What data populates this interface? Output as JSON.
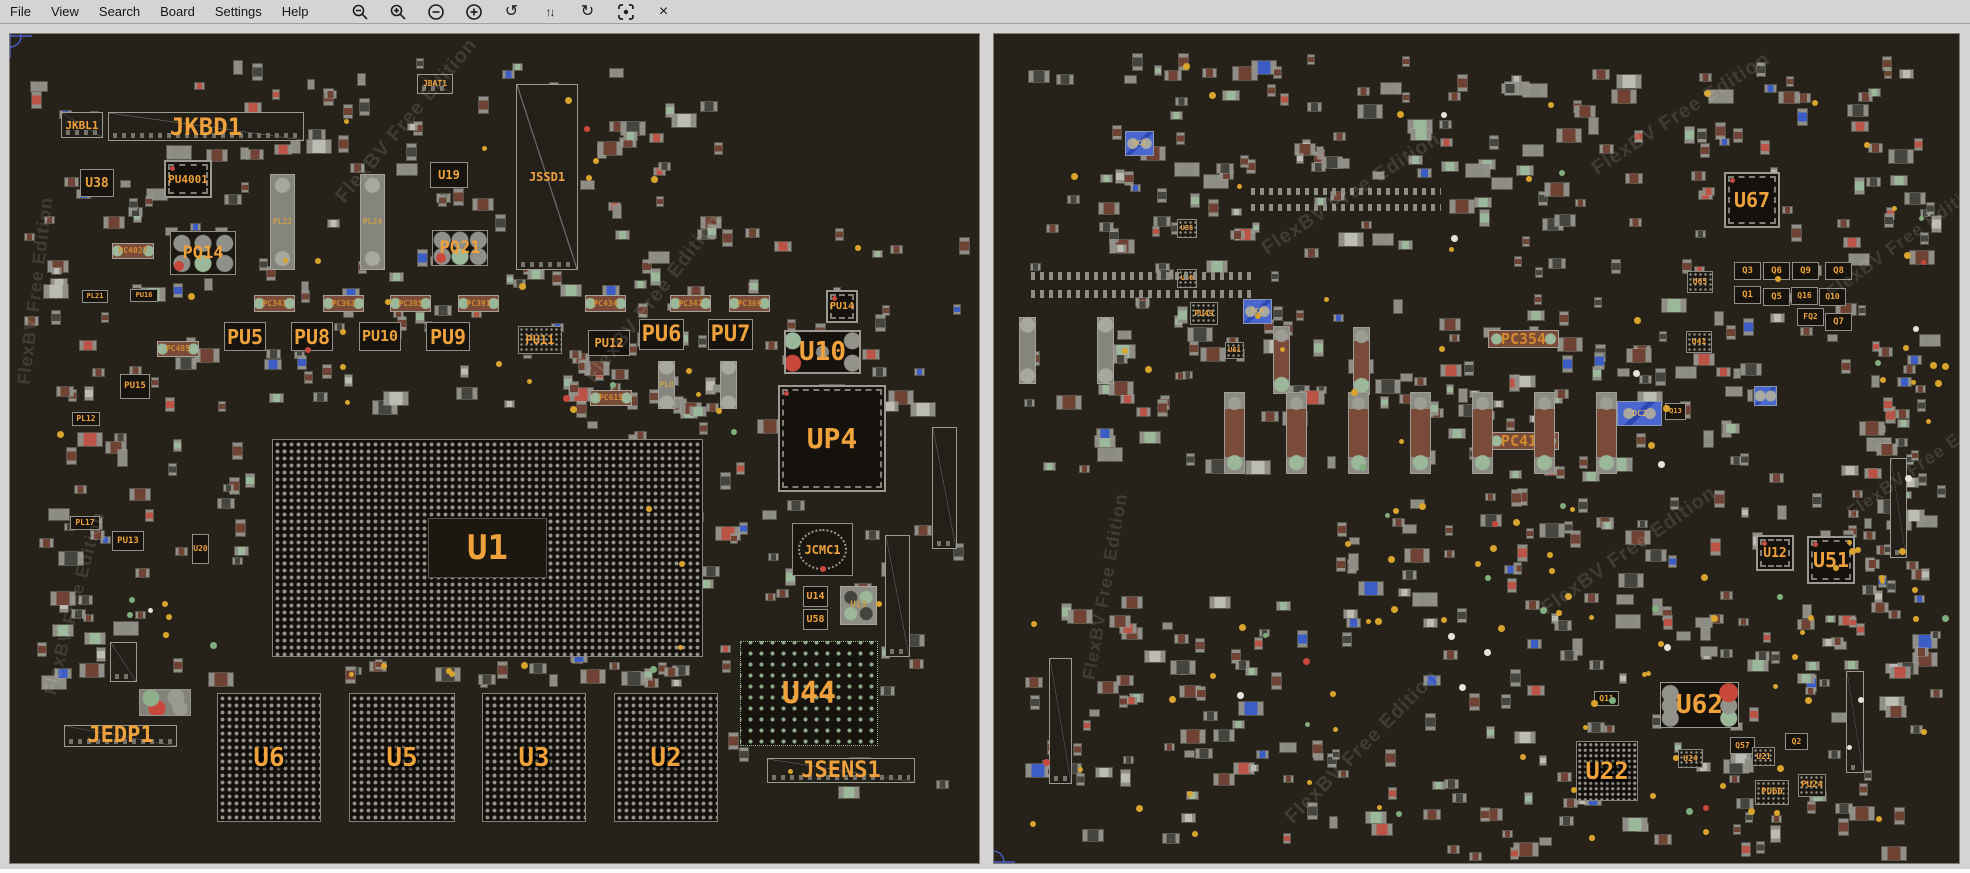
{
  "menu": {
    "items": [
      "File",
      "View",
      "Search",
      "Board",
      "Settings",
      "Help"
    ]
  },
  "toolbar": {
    "icons": [
      {
        "name": "zoom-out-icon",
        "kind": "svg-zoom-out"
      },
      {
        "name": "zoom-in-icon",
        "kind": "svg-zoom-in"
      },
      {
        "name": "minus-circle-icon",
        "kind": "svg-minus-circle"
      },
      {
        "name": "plus-circle-icon",
        "kind": "svg-plus-circle"
      },
      {
        "name": "rotate-ccw-icon",
        "kind": "glyph",
        "glyph": "↺"
      },
      {
        "name": "flip-vertical-icon",
        "kind": "glyph2",
        "glyph": "↑↓"
      },
      {
        "name": "rotate-cw-icon",
        "kind": "glyph",
        "glyph": "↻"
      },
      {
        "name": "center-target-icon",
        "kind": "svg-target"
      },
      {
        "name": "close-icon",
        "kind": "glyph",
        "glyph": "×"
      }
    ]
  },
  "watermark": "FlexBV Free Edition",
  "colors": {
    "menu_bg": "#d5d4d2",
    "board_bg": "#272219",
    "label_orange": "#efa23c",
    "blue_part": "#4a67cf",
    "test_point_yellow": "#d9a42e",
    "crosshair_blue": "#4b5fc7"
  },
  "left_board": {
    "components": [
      [
        "conn",
        "JKBL1",
        51,
        78,
        42,
        26,
        11
      ],
      [
        "conn",
        "JKBD1",
        98,
        78,
        196,
        29,
        24
      ],
      [
        "conn",
        "JSSD1",
        506,
        50,
        62,
        186,
        12
      ],
      [
        "conn",
        "JBAT1",
        407,
        40,
        36,
        20,
        8
      ],
      [
        "chip",
        "U38",
        70,
        135,
        34,
        28,
        13
      ],
      [
        "qfn",
        "PU4001",
        154,
        126,
        48,
        38,
        11
      ],
      [
        "chip",
        "U19",
        420,
        128,
        38,
        26,
        12
      ],
      [
        "pq",
        "PQ14",
        160,
        197,
        66,
        44,
        17
      ],
      [
        "pq",
        "PQ21",
        422,
        196,
        56,
        36,
        17
      ],
      [
        "pl",
        "PL22",
        260,
        140,
        25,
        96,
        8
      ],
      [
        "pl",
        "PL24",
        350,
        140,
        25,
        96,
        8
      ],
      [
        "cap",
        "PC4027",
        102,
        209,
        42,
        16,
        8
      ],
      [
        "chip",
        "PU16",
        120,
        255,
        28,
        13,
        7
      ],
      [
        "chip",
        "PL21",
        72,
        256,
        26,
        13,
        7
      ],
      [
        "cap",
        "PC341",
        244,
        261,
        41,
        17,
        8
      ],
      [
        "cap",
        "PC363",
        313,
        261,
        41,
        17,
        8
      ],
      [
        "cap",
        "PC385",
        380,
        261,
        41,
        17,
        8
      ],
      [
        "cap",
        "PC391",
        448,
        261,
        41,
        17,
        8
      ],
      [
        "cap",
        "PC434",
        575,
        261,
        41,
        17,
        8
      ],
      [
        "cap",
        "PC347",
        660,
        261,
        41,
        17,
        8
      ],
      [
        "cap",
        "PC369",
        719,
        261,
        41,
        17,
        8
      ],
      [
        "chip",
        "PU5",
        214,
        288,
        42,
        29,
        20
      ],
      [
        "chip",
        "PU8",
        281,
        288,
        42,
        29,
        20
      ],
      [
        "chip",
        "PU10",
        349,
        288,
        42,
        29,
        15
      ],
      [
        "chip",
        "PU9",
        416,
        288,
        44,
        29,
        20
      ],
      [
        "grid",
        "PU11",
        508,
        292,
        44,
        28,
        12
      ],
      [
        "chip",
        "PU12",
        578,
        296,
        42,
        26,
        12
      ],
      [
        "chip",
        "PU6",
        629,
        285,
        45,
        31,
        22
      ],
      [
        "chip",
        "PU7",
        698,
        285,
        45,
        31,
        22
      ],
      [
        "cap",
        "PC485",
        147,
        307,
        42,
        16,
        8
      ],
      [
        "chip",
        "PU15",
        110,
        340,
        30,
        25,
        9
      ],
      [
        "cap",
        "PC615",
        580,
        356,
        42,
        16,
        8
      ],
      [
        "pl",
        "PL8",
        648,
        327,
        17,
        48,
        8
      ],
      [
        "pl",
        "",
        710,
        327,
        17,
        48,
        0
      ],
      [
        "chip",
        "PL12",
        62,
        378,
        28,
        14,
        8
      ],
      [
        "chip",
        "PL17",
        60,
        482,
        30,
        14,
        8
      ],
      [
        "chip",
        "PU13",
        102,
        497,
        32,
        20,
        9
      ],
      [
        "chip",
        "U20",
        182,
        500,
        17,
        30,
        8
      ],
      [
        "qfn",
        "PU14",
        816,
        256,
        32,
        33,
        10
      ],
      [
        "u10",
        "U10",
        774,
        296,
        77,
        44,
        26
      ],
      [
        "qfn",
        "UP4",
        768,
        351,
        108,
        107,
        28
      ],
      [
        "ring",
        "JCMC1",
        782,
        489,
        61,
        53,
        12
      ],
      [
        "chip",
        "U14",
        793,
        552,
        25,
        21,
        10
      ],
      [
        "chip",
        "U58",
        793,
        575,
        25,
        21,
        10
      ],
      [
        "circ4",
        "U13",
        830,
        552,
        37,
        39,
        9
      ],
      [
        "conn",
        "",
        875,
        501,
        25,
        122,
        0
      ],
      [
        "conn",
        "",
        922,
        393,
        25,
        122,
        0
      ],
      [
        "bga2",
        "U44",
        730,
        607,
        138,
        105,
        30
      ],
      [
        "conn",
        "JSENS1",
        757,
        724,
        148,
        25,
        22
      ],
      [
        "bgadie",
        "U1",
        262,
        405,
        431,
        218,
        34
      ],
      [
        "bga",
        "U6",
        207,
        659,
        104,
        129,
        26
      ],
      [
        "bga",
        "U5",
        339,
        659,
        106,
        129,
        26
      ],
      [
        "bga",
        "U3",
        472,
        659,
        104,
        129,
        26
      ],
      [
        "bga",
        "U2",
        604,
        659,
        104,
        129,
        26
      ],
      [
        "cluster",
        "",
        129,
        655,
        52,
        27,
        0
      ],
      [
        "conn",
        "",
        100,
        608,
        27,
        40,
        0
      ],
      [
        "conn",
        "JEDP1",
        54,
        691,
        113,
        22,
        22
      ]
    ],
    "watermarks": [
      [
        330,
        155,
        -50,
        20
      ],
      [
        14,
        340,
        -83,
        18
      ],
      [
        580,
        335,
        -52,
        20
      ],
      [
        40,
        650,
        -75,
        18
      ]
    ],
    "crosshair": {
      "x": 0,
      "y": 2
    },
    "scatter_zones": [
      [
        15,
        25,
        700,
        185,
        85
      ],
      [
        15,
        215,
        230,
        330,
        55
      ],
      [
        240,
        215,
        470,
        170,
        65
      ],
      [
        560,
        315,
        150,
        330,
        45
      ],
      [
        695,
        180,
        265,
        590,
        75
      ],
      [
        180,
        626,
        540,
        28,
        20
      ],
      [
        20,
        555,
        190,
        105,
        15
      ]
    ],
    "dot_count": 45,
    "seed": 7
  },
  "right_board": {
    "components": [
      [
        "qfn",
        "U67",
        730,
        138,
        56,
        56,
        20
      ],
      [
        "chip",
        "Q3",
        740,
        228,
        27,
        18,
        9
      ],
      [
        "chip",
        "Q6",
        769,
        228,
        27,
        18,
        9
      ],
      [
        "chip",
        "Q9",
        798,
        228,
        27,
        18,
        9
      ],
      [
        "chip",
        "Q8",
        831,
        228,
        27,
        18,
        9
      ],
      [
        "chip",
        "Q1",
        740,
        252,
        27,
        18,
        9
      ],
      [
        "chip",
        "Q5",
        769,
        254,
        27,
        18,
        9
      ],
      [
        "chip",
        "Q16",
        797,
        253,
        27,
        18,
        8
      ],
      [
        "chip",
        "Q10",
        825,
        254,
        27,
        18,
        8
      ],
      [
        "chip",
        "FQ2",
        803,
        274,
        27,
        18,
        8
      ],
      [
        "chip",
        "Q7",
        831,
        279,
        27,
        18,
        9
      ],
      [
        "grid",
        "U65",
        693,
        237,
        26,
        22,
        8
      ],
      [
        "grid",
        "U41",
        692,
        297,
        26,
        22,
        8
      ],
      [
        "blue",
        "DC3",
        131,
        97,
        29,
        25,
        7
      ],
      [
        "grid",
        "U35",
        183,
        185,
        20,
        19,
        7
      ],
      [
        "grid",
        "U48",
        183,
        235,
        20,
        19,
        7
      ],
      [
        "grid",
        "PU49",
        196,
        268,
        28,
        23,
        8
      ],
      [
        "grid",
        "U61",
        231,
        308,
        19,
        17,
        7
      ],
      [
        "blue",
        "DC4",
        249,
        265,
        29,
        25,
        7
      ],
      [
        "cap",
        "PC354",
        494,
        296,
        71,
        18,
        15
      ],
      [
        "cap",
        "PC411",
        494,
        398,
        71,
        18,
        15
      ],
      [
        "blue",
        "DC2",
        623,
        367,
        45,
        25,
        8
      ],
      [
        "chip",
        "Q13",
        671,
        369,
        21,
        17,
        7
      ],
      [
        "blue",
        "",
        760,
        352,
        23,
        20,
        0
      ],
      [
        "pl",
        "",
        25,
        283,
        17,
        67,
        0
      ],
      [
        "pl",
        "",
        103,
        283,
        17,
        67,
        0
      ],
      [
        "pinrow",
        "",
        37,
        238,
        225,
        8,
        0
      ],
      [
        "pinrow",
        "",
        37,
        256,
        225,
        8,
        0
      ],
      [
        "pinrow",
        "",
        257,
        154,
        190,
        7,
        0
      ],
      [
        "pinrow",
        "",
        257,
        170,
        190,
        7,
        0
      ],
      [
        "tcap",
        "",
        279,
        292,
        17,
        68,
        0
      ],
      [
        "tcap",
        "",
        359,
        293,
        17,
        68,
        0
      ],
      [
        "tcap",
        "",
        230,
        358,
        21,
        82,
        0
      ],
      [
        "tcap",
        "",
        292,
        358,
        21,
        82,
        0
      ],
      [
        "tcap",
        "",
        354,
        358,
        21,
        82,
        0
      ],
      [
        "tcap",
        "",
        416,
        358,
        21,
        82,
        0
      ],
      [
        "tcap",
        "",
        478,
        358,
        21,
        82,
        0
      ],
      [
        "tcap",
        "",
        540,
        358,
        21,
        82,
        0
      ],
      [
        "tcap",
        "",
        602,
        358,
        21,
        82,
        0
      ],
      [
        "qfn",
        "U12",
        762,
        501,
        38,
        36,
        13
      ],
      [
        "qfn",
        "U51",
        813,
        502,
        48,
        48,
        20
      ],
      [
        "conn",
        "",
        55,
        624,
        23,
        126,
        0
      ],
      [
        "conn",
        "",
        852,
        637,
        18,
        102,
        0
      ],
      [
        "conn",
        "",
        896,
        424,
        17,
        100,
        0
      ],
      [
        "chip",
        "Q11",
        600,
        657,
        25,
        15,
        8
      ],
      [
        "u62",
        "U62",
        666,
        648,
        79,
        46,
        26
      ],
      [
        "chip",
        "Q57",
        736,
        703,
        25,
        17,
        8
      ],
      [
        "grid",
        "U24",
        684,
        715,
        25,
        19,
        8
      ],
      [
        "grid",
        "U21",
        758,
        713,
        23,
        19,
        8
      ],
      [
        "chip",
        "Q2",
        791,
        699,
        23,
        17,
        8
      ],
      [
        "bga3",
        "U22",
        582,
        707,
        62,
        60,
        24
      ],
      [
        "grid",
        "PU60",
        761,
        746,
        34,
        25,
        9
      ],
      [
        "grid",
        "PU24",
        804,
        740,
        28,
        23,
        9
      ]
    ],
    "watermarks": [
      [
        270,
        205,
        -33,
        20
      ],
      [
        600,
        125,
        -33,
        20
      ],
      [
        835,
        250,
        -36,
        18
      ],
      [
        550,
        565,
        -35,
        20
      ],
      [
        95,
        635,
        -80,
        18
      ],
      [
        295,
        775,
        -45,
        20
      ],
      [
        855,
        470,
        -35,
        18
      ]
    ],
    "crosshair": {
      "x": -1,
      "y": 828
    },
    "scatter_zones": [
      [
        20,
        20,
        900,
        230,
        160
      ],
      [
        20,
        260,
        910,
        190,
        135
      ],
      [
        340,
        455,
        280,
        140,
        35
      ],
      [
        620,
        440,
        330,
        200,
        55
      ],
      [
        30,
        560,
        380,
        250,
        75
      ],
      [
        430,
        580,
        520,
        250,
        95
      ],
      [
        860,
        60,
        95,
        560,
        40
      ]
    ],
    "dot_count": 130,
    "seed": 21
  }
}
